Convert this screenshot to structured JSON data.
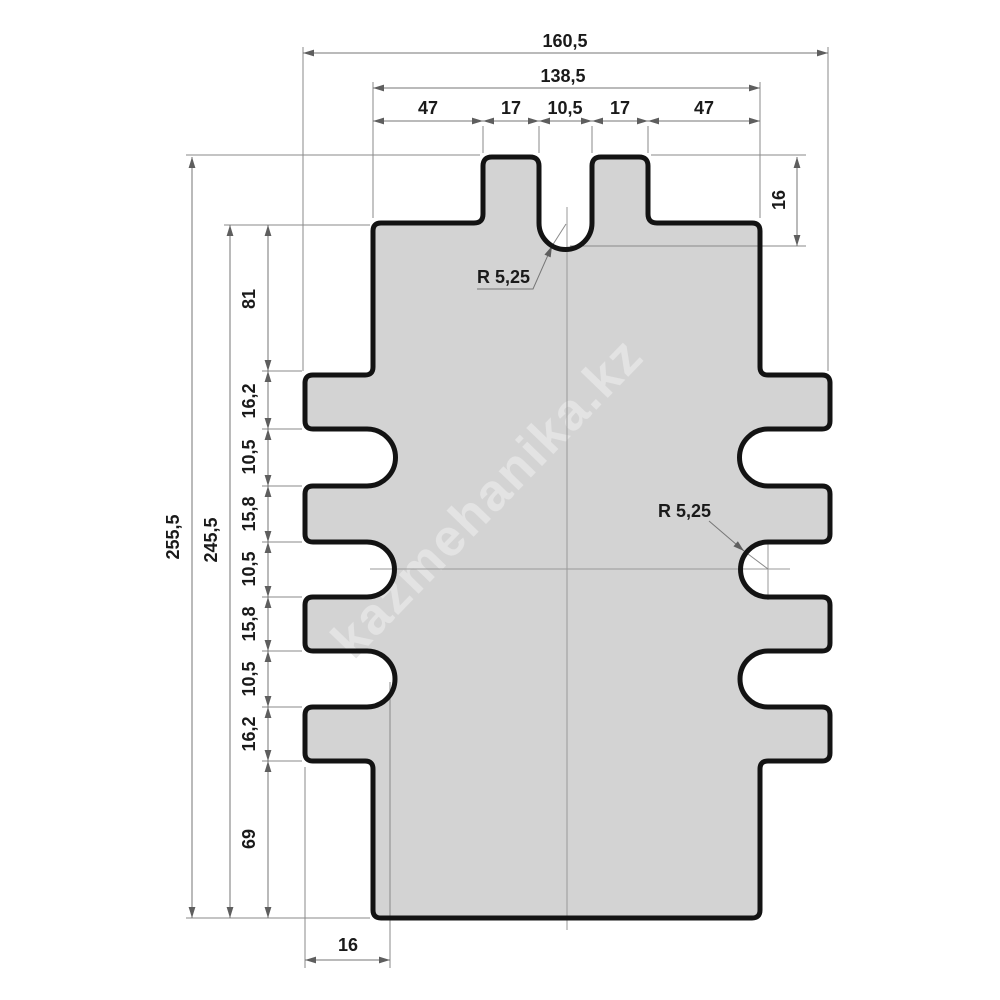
{
  "drawing": {
    "title_watermark": "kazmehanika.kz",
    "colors": {
      "background": "#ffffff",
      "part_fill": "#d3d3d3",
      "part_outline": "#131313",
      "dimension_lines": "#767676",
      "dimension_text": "#1a1a1a",
      "watermark_text": "#e4e4e4"
    },
    "dims": {
      "top": {
        "overall_width": "160,5",
        "body_width": "138,5",
        "segments": [
          "47",
          "17",
          "10,5",
          "17",
          "47"
        ]
      },
      "left": {
        "overall_height": "255,5",
        "body_height": "245,5",
        "chain": [
          "81",
          "16,2",
          "10,5",
          "15,8",
          "10,5",
          "15,8",
          "10,5",
          "16,2",
          "69"
        ]
      },
      "right": {
        "tooth_notch_depth": "16"
      },
      "bottom": {
        "side_notch_depth": "16"
      },
      "radii": {
        "top_notch": "R 5,25",
        "side_notch": "R 5,25"
      }
    }
  }
}
